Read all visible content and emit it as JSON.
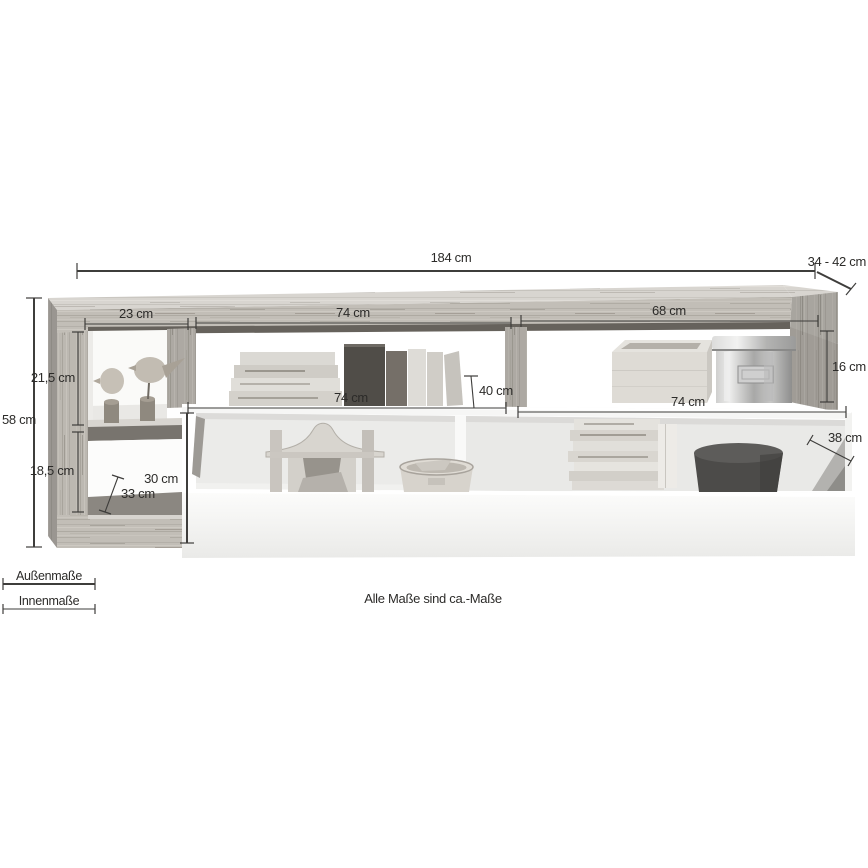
{
  "note": "Alle Maße sind ca.-Maße",
  "legend": {
    "outer_label": "Außenmaße",
    "inner_label": "Innenmaße"
  },
  "dimensions": {
    "total_width": "184 cm",
    "depth_range": "34 - 42 cm",
    "total_height": "58 cm",
    "upper_left_inner_width": "23 cm",
    "upper_middle_inner_width": "74 cm",
    "upper_right_inner_width": "68 cm",
    "upper_left_inner_height": "21,5 cm",
    "lower_left_inner_height": "18,5 cm",
    "lower_left_depth": "33 cm",
    "shelf_depth": "40 cm",
    "upper_right_inner_height": "16 cm",
    "lowboard_left_top_width": "74 cm",
    "lowboard_right_top_width": "74 cm",
    "body_front_height": "30 cm",
    "right_inner_depth": "38 cm"
  },
  "colors": {
    "background": "#ffffff",
    "dimension_line": "#3e3d3b",
    "label_text": "#2c2b29",
    "wood_mid": "#c2beb7",
    "wood_light": "#d8d5d0",
    "wood_shadow": "#66625c",
    "body_white": "#f6f6f5"
  }
}
